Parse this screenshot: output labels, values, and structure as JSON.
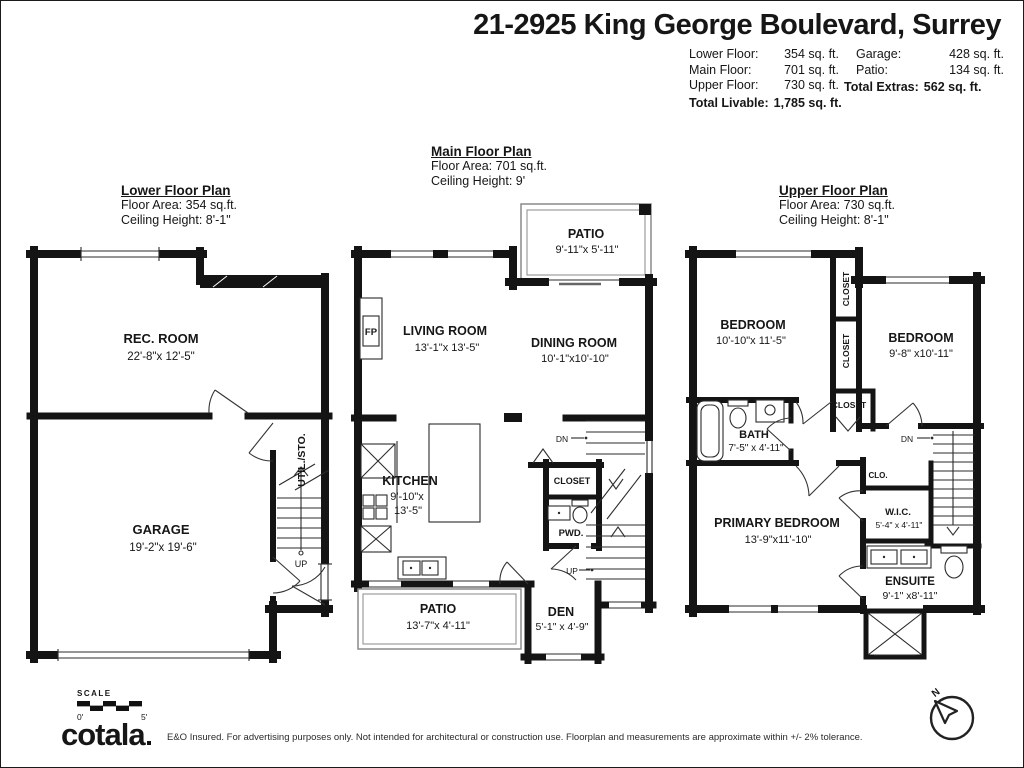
{
  "header": {
    "title": "21-2925 King George Boulevard, Surrey",
    "stats_left": {
      "rows": [
        {
          "label": "Lower Floor:",
          "value": "354 sq. ft."
        },
        {
          "label": "Main Floor:",
          "value": "701 sq. ft."
        },
        {
          "label": "Upper Floor:",
          "value": "730 sq. ft."
        }
      ],
      "total_label": "Total Livable:",
      "total_value": "1,785 sq. ft."
    },
    "stats_right": {
      "rows": [
        {
          "label": "Garage:",
          "value": "428 sq. ft."
        },
        {
          "label": "Patio:",
          "value": "134 sq. ft."
        }
      ],
      "total_label": "Total Extras:",
      "total_value": "562 sq. ft."
    }
  },
  "plans": {
    "lower": {
      "title": "Lower Floor Plan",
      "area": "Floor Area: 354 sq.ft.",
      "ceiling": "Ceiling Height: 8'-1\"",
      "rec_room_name": "REC. ROOM",
      "rec_room_dims": "22'-8\"x 12'-5\"",
      "garage_name": "GARAGE",
      "garage_dims": "19'-2\"x 19'-6\"",
      "util_label": "UTIL./STO.",
      "up_label": "UP"
    },
    "main": {
      "title": "Main Floor Plan",
      "area": "Floor Area: 701 sq.ft.",
      "ceiling": "Ceiling Height: 9'",
      "patio_top_name": "PATIO",
      "patio_top_dims": "9'-11\"x 5'-11\"",
      "living_name": "LIVING ROOM",
      "living_dims": "13'-1\"x 13'-5\"",
      "dining_name": "DINING ROOM",
      "dining_dims": "10'-1\"x10'-10\"",
      "kitchen_name": "KITCHEN",
      "kitchen_dims1": "9'-10\"x",
      "kitchen_dims2": "13'-5\"",
      "fp_label": "FP",
      "closet_label": "CLOSET",
      "pwd_label": "PWD.",
      "patio_bottom_name": "PATIO",
      "patio_bottom_dims": "13'-7\"x 4'-11\"",
      "den_name": "DEN",
      "den_dims": "5'-1\" x 4'-9\"",
      "dn_label": "DN",
      "up_label": "UP"
    },
    "upper": {
      "title": "Upper Floor Plan",
      "area": "Floor Area: 730 sq.ft.",
      "ceiling": "Ceiling Height: 8'-1\"",
      "bedroom1_name": "BEDROOM",
      "bedroom1_dims": "10'-10\"x 11'-5\"",
      "bedroom2_name": "BEDROOM",
      "bedroom2_dims": "9'-8\" x10'-11\"",
      "closet_a": "CLOSET",
      "closet_b": "CLOSET",
      "closet_c": "CLOSET",
      "bath_name": "BATH",
      "bath_dims": "7'-5\" x 4'-11\"",
      "primary_name": "PRIMARY BEDROOM",
      "primary_dims": "13'-9\"x11'-10\"",
      "clo_label": "CLO.",
      "wic_name": "W.I.C.",
      "wic_dims": "5'-4\" x 4'-11\"",
      "ensuite_name": "ENSUITE",
      "ensuite_dims": "9'-1\" x8'-11\"",
      "dn_label": "DN"
    }
  },
  "footer": {
    "scale_label": "SCALE",
    "scale_start": "0'",
    "scale_end": "5'",
    "brand": "cotala",
    "disclaimer": "E&O Insured. For advertising purposes only. Not intended for architectural or construction use. Floorplan and measurements are approximate within +/- 2% tolerance.",
    "compass_n": "N"
  }
}
